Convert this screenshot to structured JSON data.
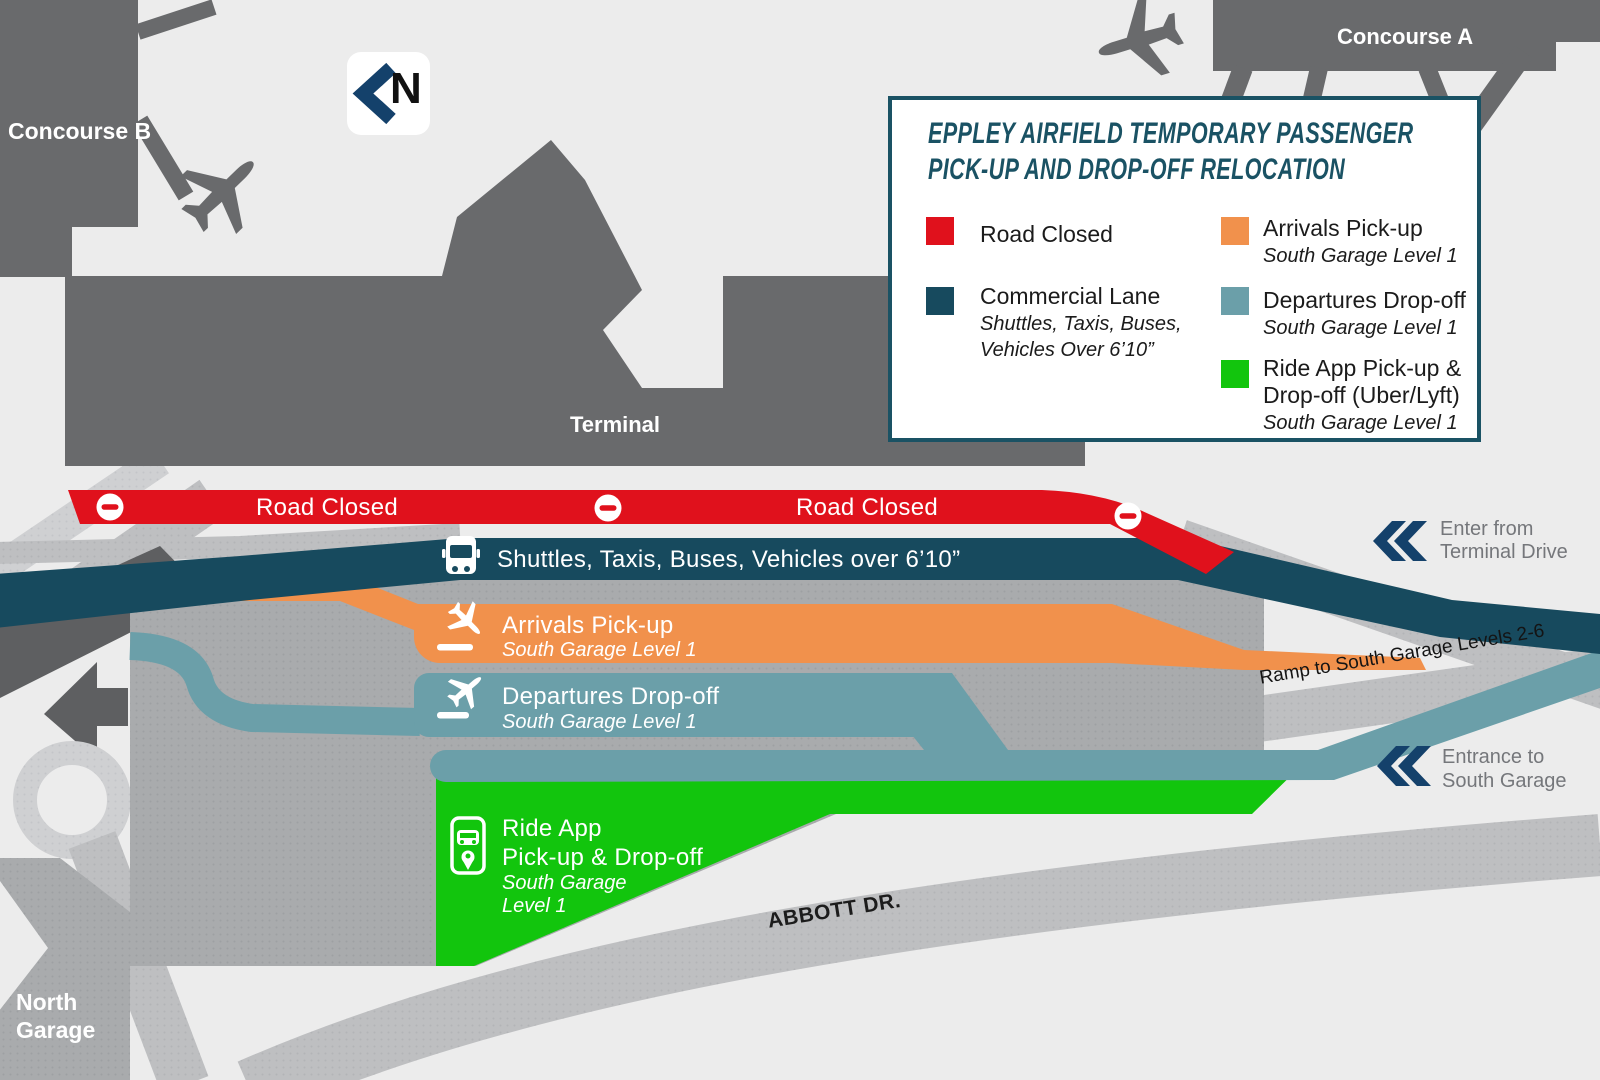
{
  "map": {
    "north_indicator": "N",
    "areas": {
      "concourse_b": "Concourse B",
      "concourse_a": "Concourse A",
      "terminal": "Terminal",
      "north_garage_line1": "North",
      "north_garage_line2": "Garage"
    },
    "bands": {
      "road_closed": {
        "label": "Road Closed",
        "color": "#E0111C",
        "icon": "no-entry-icon"
      },
      "commercial": {
        "label": "Shuttles, Taxis, Buses, Vehicles over 6’10”",
        "color": "#174A5E",
        "icon": "bus-icon"
      },
      "arrivals": {
        "title": "Arrivals Pick-up",
        "subtitle": "South Garage Level 1",
        "color": "#F1914C",
        "icon": "plane-landing-icon"
      },
      "departures": {
        "title": "Departures Drop-off",
        "subtitle": "South Garage Level 1",
        "color": "#6B9FA9",
        "icon": "plane-takeoff-icon"
      },
      "ride_app": {
        "line1": "Ride App",
        "line2": "Pick-up & Drop-off",
        "line3": "South Garage",
        "line4": "Level 1",
        "color": "#12C50D",
        "icon": "ride-app-phone-icon"
      }
    },
    "annotations": {
      "enter_line1": "Enter from",
      "enter_line2": "Terminal Drive",
      "ramp": "Ramp to South Garage Levels 2-6",
      "entrance_line1": "Entrance to",
      "entrance_line2": "South Garage",
      "abbott": "ABBOTT DR."
    }
  },
  "legend": {
    "title_line1": "EPPLEY AIRFIELD TEMPORARY PASSENGER",
    "title_line2": "PICK-UP AND DROP-OFF RELOCATION",
    "items": [
      {
        "label": "Road Closed",
        "color": "#E0111C"
      },
      {
        "label": "Commercial Lane",
        "sub_line1": "Shuttles, Taxis, Buses,",
        "sub_line2": "Vehicles Over 6’10”",
        "color": "#174A5E"
      },
      {
        "label": "Arrivals Pick-up",
        "sub": "South Garage Level 1",
        "color": "#F1914C"
      },
      {
        "label": "Departures Drop-off",
        "sub": "South Garage Level 1",
        "color": "#6B9FA9"
      },
      {
        "label_line1": "Ride App Pick-up &",
        "label_line2": "Drop-off (Uber/Lyft)",
        "sub": "South Garage Level 1",
        "color": "#12C50D"
      }
    ]
  },
  "colors": {
    "background": "#ECECEC",
    "terminal_gray": "#696A6C",
    "garage_gray": "#A9ABAD",
    "road_gray": "#BEBFC1",
    "road_light_gray": "#CFD0D2",
    "bridge_dark_gray": "#5E5F61",
    "road_closed_red": "#E0111C",
    "commercial_navy": "#174A5E",
    "arrivals_orange": "#F1914C",
    "departures_teal": "#6B9FA9",
    "ride_app_green": "#12C50D",
    "chevron_navy": "#14416B",
    "legend_navy": "#1A5264",
    "annotation_gray": "#75777B"
  }
}
